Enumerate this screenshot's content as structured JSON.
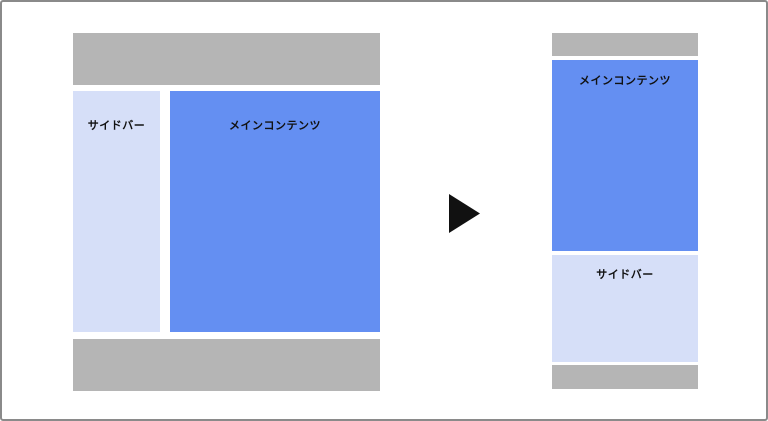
{
  "diagram": {
    "desktop": {
      "sidebar_label": "サイドバー",
      "main_label": "メインコンテンツ"
    },
    "mobile": {
      "main_label": "メインコンテンツ",
      "sidebar_label": "サイドバー"
    },
    "arrow": {
      "icon": "right-triangle-arrow"
    },
    "colors": {
      "header_footer": "#b5b5b5",
      "main": "#648ff2",
      "sidebar": "#d6dff8",
      "arrow": "#111111",
      "text": "#111111",
      "frame": "#8a8a8a"
    }
  }
}
